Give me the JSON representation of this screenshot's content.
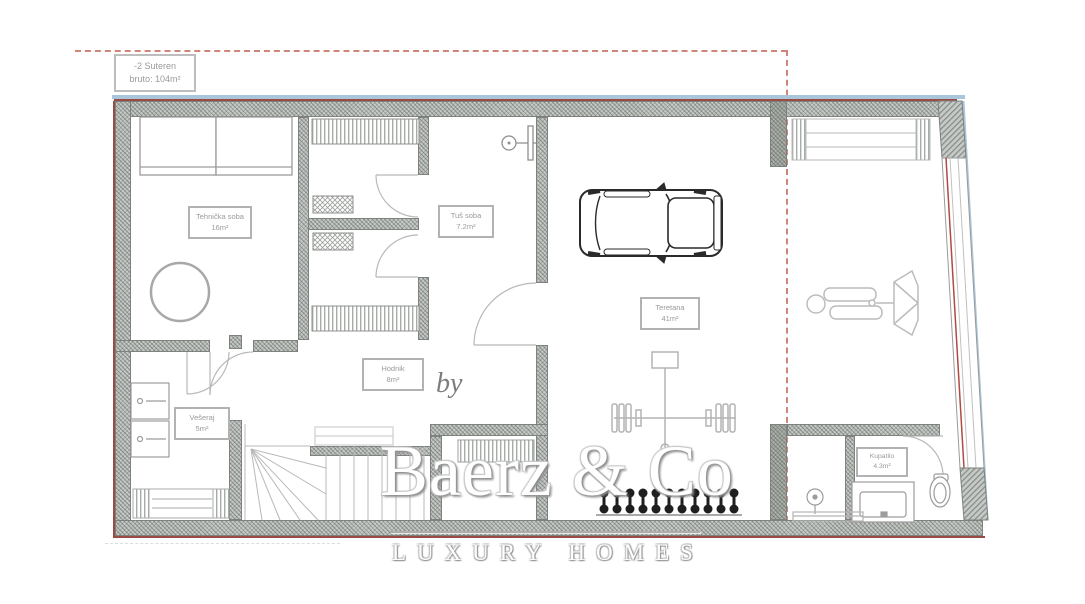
{
  "plan": {
    "title": {
      "level": "-2 Suteren",
      "area": "bruto: 104m²"
    },
    "rooms": [
      {
        "name": "Tehnička soba",
        "area": "16m²"
      },
      {
        "name": "Tuš soba",
        "area": "7.2m²"
      },
      {
        "name": "Teretana",
        "area": "41m²"
      },
      {
        "name": "Hodnik",
        "area": "8m²"
      },
      {
        "name": "Vešeraj",
        "area": "5m²"
      },
      {
        "name": "Kupatilo",
        "area": "4.3m²"
      }
    ],
    "icons": [
      "car-icon",
      "squat-rack-icon",
      "dumbbell-rack-icon",
      "treadmill-icon",
      "stairs-icon",
      "shower-icon",
      "hand-shower-icon",
      "hot-tub-icon",
      "sauna-bench-icon",
      "vent-icon",
      "cabinet-icon",
      "washer-icon",
      "bench-icon",
      "vanity-icon",
      "toilet-icon"
    ]
  },
  "watermark": {
    "prefix": "by",
    "brand": "Baerz & Co",
    "tagline": "LUXURY HOMES"
  },
  "colors": {
    "boundary_dash": "#d08579",
    "outer_blue": "#a9c6db",
    "outer_red": "#9a4b44",
    "wall_gray": "#c6cac6",
    "line_gray": "#a8a8a8",
    "label_gray": "#9a9a9a",
    "equipment_black": "#1f1f1f"
  }
}
